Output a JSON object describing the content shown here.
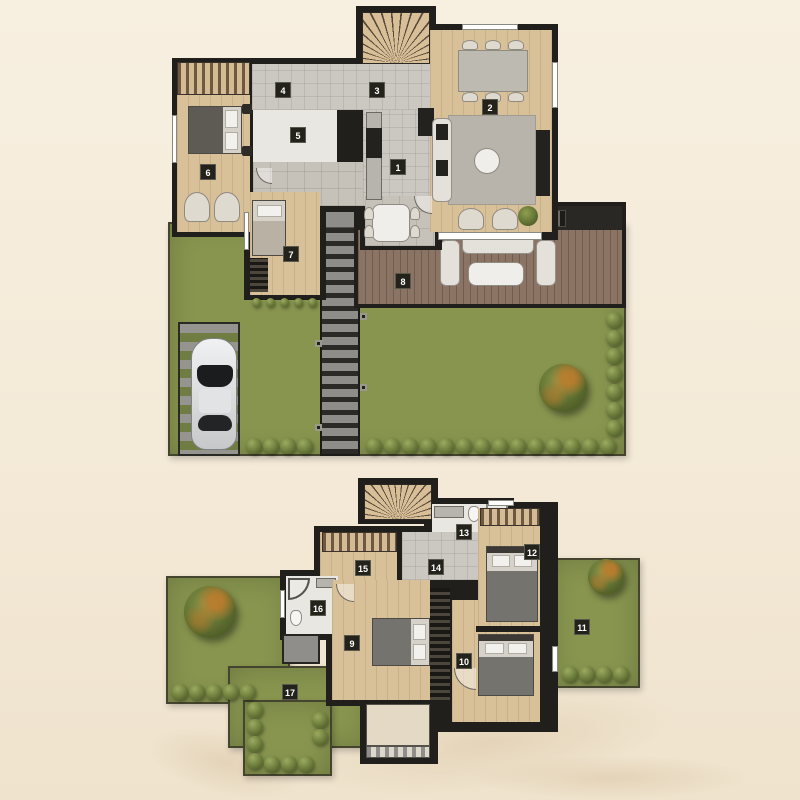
{
  "palette": {
    "wall": "#211f1b",
    "grass": "#87954f",
    "wood": "#d8c099",
    "deck": "#8b7463",
    "badge_bg": "#23231b",
    "badge_text": "#ffffff"
  },
  "ground_floor": {
    "room_labels": [
      "1",
      "2",
      "3",
      "4",
      "5",
      "6",
      "7",
      "8"
    ]
  },
  "first_floor": {
    "room_labels": [
      "9",
      "10",
      "11",
      "12",
      "13",
      "14",
      "15",
      "16",
      "17"
    ]
  }
}
